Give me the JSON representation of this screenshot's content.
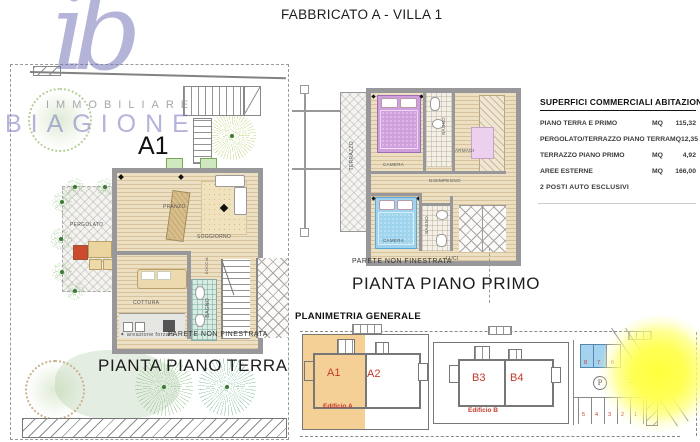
{
  "title": "FABBRICATO A - VILLA 1",
  "logo": {
    "monogram": "ib",
    "line1": "IMMOBILIARE",
    "line2": "BIAGIONE"
  },
  "ground_floor": {
    "unit": "A1",
    "title": "PIANTA PIANO TERRA",
    "rooms": {
      "pergolato": "PERGOLATO",
      "pranzo": "PRANZO",
      "soggiorno": "SOGGIORNO",
      "cottura": "COTTURA",
      "bagno": "BAGNO",
      "doccia": "DOCCIA"
    },
    "ventilation_note": "areazione forzata",
    "wall_note": "PARETE NON FINESTRATA"
  },
  "first_floor": {
    "title": "PIANTA PIANO PRIMO",
    "rooms": {
      "terrazzo": "TERRAZZO",
      "camera_top": "CAMERA",
      "bagno_top": "BAGNO",
      "armadi": "ARMADI",
      "disimpegno": "DISIMPEGNO",
      "camera_bottom": "CAMERA",
      "bagno_bottom": "BAGNO"
    },
    "wall_note": "PARETE NON FINESTRATA",
    "lights_note": "LUCI"
  },
  "surfaces": {
    "heading": "SUPERFICI COMMERCIALI ABITAZIONE",
    "rows": [
      {
        "label": "PIANO TERRA E PRIMO",
        "unit": "MQ",
        "value": "115,32"
      },
      {
        "label": "PERGOLATO/TERRAZZO PIANO TERRA",
        "unit": "MQ",
        "value": "12,35"
      },
      {
        "label": "TERRAZZO PIANO PRIMO",
        "unit": "MQ",
        "value": "4,92"
      },
      {
        "label": "AREE ESTERNE",
        "unit": "MQ",
        "value": "166,00"
      }
    ],
    "footnote": "2 POSTI AUTO ESCLUSIVI"
  },
  "site_plan": {
    "heading": "PLANIMETRIA GENERALE",
    "units": [
      "A1",
      "A2",
      "B3",
      "B4"
    ],
    "buildings": [
      "Edificio A",
      "Edificio B"
    ],
    "parking": {
      "symbol": "P",
      "spaces_top": [
        "8",
        "7",
        "6"
      ],
      "spaces_bottom": [
        "5",
        "4",
        "3",
        "2",
        "1"
      ]
    }
  },
  "colors": {
    "accent_red": "#c23b2e",
    "highlight_orange": "#f4d096",
    "parking_blue": "#a5d2ee",
    "sun_yellow": "#ffff55",
    "logo_periwinkle": "#7d7dc0"
  }
}
